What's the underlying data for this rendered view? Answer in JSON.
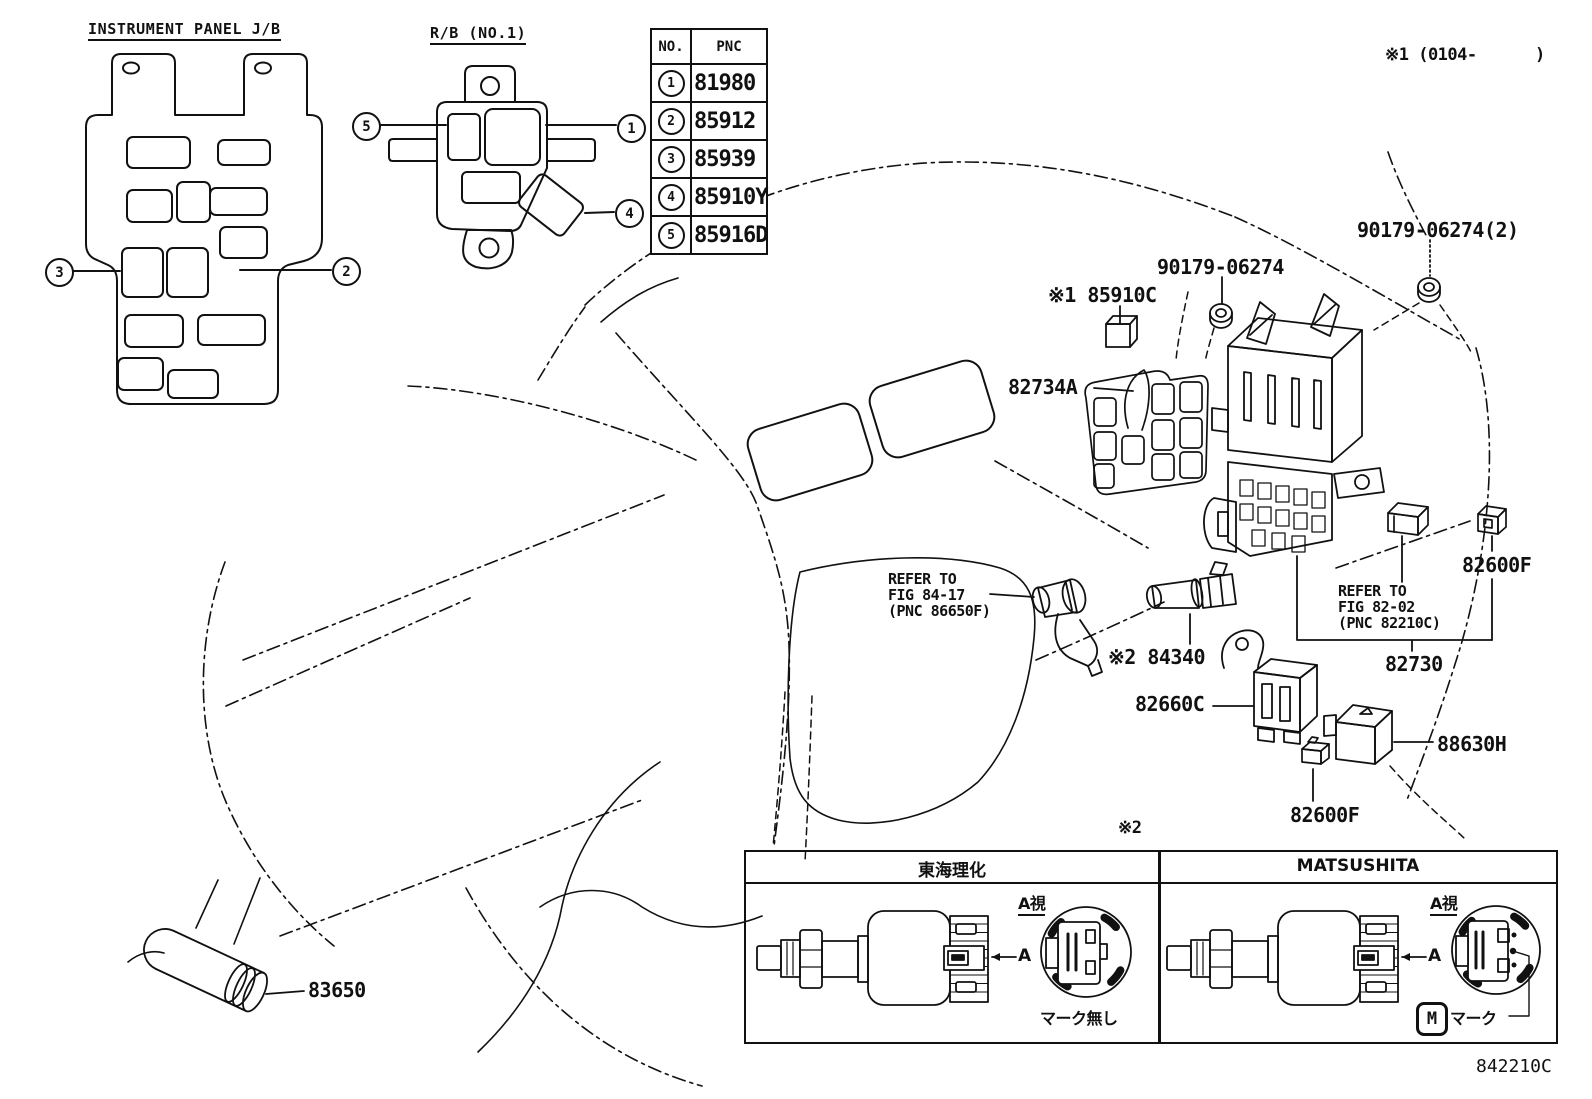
{
  "page": {
    "background": "#ffffff",
    "ink": "#111111",
    "footer_code": "842210C",
    "top_right_note": "※1 (0104-      )"
  },
  "instrument_panel": {
    "title": "INSTRUMENT PANEL J/B",
    "callout_left": "3",
    "callout_right": "2"
  },
  "relay_block": {
    "title": "R/B (NO.1)",
    "callout_left": "5",
    "callout_right": "1",
    "callout_bottom": "4"
  },
  "pnc_table": {
    "no_header": "NO.",
    "pnc_header": "PNC",
    "rows": [
      {
        "no": "1",
        "pnc": "81980"
      },
      {
        "no": "2",
        "pnc": "85912"
      },
      {
        "no": "3",
        "pnc": "85939"
      },
      {
        "no": "4",
        "pnc": "85910Y"
      },
      {
        "no": "5",
        "pnc": "85916D"
      }
    ]
  },
  "labels": {
    "nut_front": "90179-06274",
    "nut_rear": "90179-06274(2)",
    "relay_85910c": "※1 85910C",
    "block_82734a": "82734A",
    "connector_82600f_upper": "82600F",
    "refer_84_17": [
      "REFER TO",
      "FIG 84-17",
      "(PNC 86650F)"
    ],
    "refer_82_02": [
      "REFER TO",
      "FIG 82-02",
      "(PNC 82210C)"
    ],
    "switch_84340": "※2 84340",
    "junction_82730": "82730",
    "relay_82660c": "82660C",
    "relay_88630h": "88630H",
    "cover_82600f_lower": "82600F",
    "note_2": "※2",
    "cylinder_83650": "83650"
  },
  "comparison": {
    "note": "※2",
    "left_header": "東海理化",
    "right_header": "MATSUSHITA",
    "view_label": "A視",
    "arrow_label": "A",
    "no_mark_label": "マーク無し",
    "mark_label": "マーク",
    "logo_letter": "M"
  }
}
